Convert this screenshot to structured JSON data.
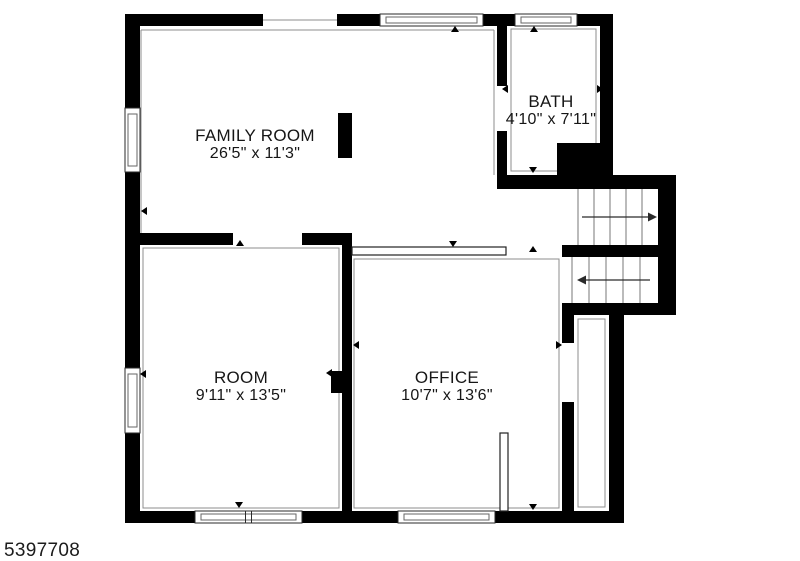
{
  "listing_id": "5397708",
  "rooms": [
    {
      "name": "FAMILY ROOM",
      "dims": "26'5\" x 11'3\"",
      "cx": 255,
      "cy": 145
    },
    {
      "name": "BATH",
      "dims": "4'10\" x 7'11\"",
      "cx": 551,
      "cy": 111
    },
    {
      "name": "ROOM",
      "dims": "9'11\" x 13'5\"",
      "cx": 241,
      "cy": 387
    },
    {
      "name": "OFFICE",
      "dims": "10'7\" x 13'6\"",
      "cx": 447,
      "cy": 387
    }
  ],
  "floorplan": {
    "colors": {
      "wall": "#000000",
      "outline": "#8c8c8c",
      "window_frame": "#2a2a2a",
      "window_inner": "#666666",
      "tread": "#777777",
      "arrow": "#2a2a2a",
      "marker": "#000000",
      "bar": "#222222"
    },
    "walls": [
      [
        125,
        14,
        138,
        12
      ],
      [
        337,
        14,
        43,
        12
      ],
      [
        483,
        14,
        32,
        12
      ],
      [
        577,
        14,
        36,
        12
      ],
      [
        125,
        14,
        15,
        94
      ],
      [
        125,
        172,
        15,
        196
      ],
      [
        125,
        433,
        15,
        90
      ],
      [
        125,
        511,
        70,
        12
      ],
      [
        302,
        511,
        96,
        12
      ],
      [
        495,
        511,
        129,
        12
      ],
      [
        600,
        14,
        13,
        133
      ],
      [
        497,
        14,
        10,
        72
      ],
      [
        497,
        131,
        10,
        46
      ],
      [
        497,
        175,
        179,
        14
      ],
      [
        557,
        143,
        56,
        46
      ],
      [
        658,
        177,
        18,
        138
      ],
      [
        562,
        245,
        96,
        12
      ],
      [
        562,
        303,
        114,
        12
      ],
      [
        609,
        303,
        15,
        220
      ],
      [
        562,
        303,
        12,
        40
      ],
      [
        562,
        402,
        12,
        110
      ],
      [
        125,
        233,
        108,
        12
      ],
      [
        302,
        233,
        50,
        12
      ],
      [
        342,
        233,
        10,
        290
      ],
      [
        331,
        371,
        21,
        22
      ],
      [
        338,
        113,
        14,
        45
      ]
    ],
    "windows": [
      {
        "x": 380,
        "y": 14,
        "w": 103,
        "h": 12,
        "o": "h",
        "mullion": false
      },
      {
        "x": 515,
        "y": 14,
        "w": 62,
        "h": 12,
        "o": "h",
        "mullion": false
      },
      {
        "x": 195,
        "y": 511,
        "w": 107,
        "h": 12,
        "o": "h",
        "mullion": true
      },
      {
        "x": 398,
        "y": 511,
        "w": 97,
        "h": 12,
        "o": "h",
        "mullion": false
      },
      {
        "x": 125,
        "y": 108,
        "w": 15,
        "h": 64,
        "o": "v",
        "mullion": false
      },
      {
        "x": 125,
        "y": 368,
        "w": 15,
        "h": 65,
        "o": "v",
        "mullion": false
      }
    ],
    "outline_lines": [
      [
        141,
        30,
        494,
        30
      ],
      [
        141,
        30,
        141,
        233
      ],
      [
        494,
        30,
        494,
        175
      ],
      [
        263,
        20,
        337,
        20
      ]
    ],
    "outline_rects": [
      [
        143,
        248,
        196,
        260
      ],
      [
        354,
        259,
        205,
        249
      ],
      [
        511,
        29,
        85,
        142
      ],
      [
        578,
        319,
        27,
        188
      ]
    ],
    "thin_bars": [
      [
        352,
        247,
        154,
        8
      ],
      [
        500,
        433,
        8,
        78
      ]
    ],
    "stairs": [
      {
        "left": 578,
        "top": 189,
        "bottom": 245,
        "tread_xs": [
          594,
          610,
          626,
          642
        ],
        "arrow": {
          "y": 217,
          "x1": 582,
          "x2": 650,
          "tip": 657,
          "dir": "right"
        }
      },
      {
        "left": 572,
        "top": 257,
        "bottom": 303,
        "tread_xs": [
          589,
          606,
          623,
          640
        ],
        "arrow": {
          "y": 280,
          "x1": 584,
          "x2": 650,
          "tip": 577,
          "dir": "left"
        }
      }
    ],
    "markers": [
      {
        "x": 240,
        "y": 243,
        "dir": "up"
      },
      {
        "x": 144,
        "y": 211,
        "dir": "left"
      },
      {
        "x": 453,
        "y": 244,
        "dir": "down"
      },
      {
        "x": 533,
        "y": 249,
        "dir": "up"
      },
      {
        "x": 455,
        "y": 29,
        "dir": "up"
      },
      {
        "x": 534,
        "y": 29,
        "dir": "up"
      },
      {
        "x": 505,
        "y": 89,
        "dir": "left"
      },
      {
        "x": 600,
        "y": 89,
        "dir": "right"
      },
      {
        "x": 533,
        "y": 170,
        "dir": "down"
      },
      {
        "x": 143,
        "y": 374,
        "dir": "left"
      },
      {
        "x": 356,
        "y": 345,
        "dir": "left"
      },
      {
        "x": 329,
        "y": 373,
        "dir": "left"
      },
      {
        "x": 559,
        "y": 345,
        "dir": "right"
      },
      {
        "x": 239,
        "y": 505,
        "dir": "down"
      },
      {
        "x": 533,
        "y": 507,
        "dir": "down"
      }
    ]
  }
}
